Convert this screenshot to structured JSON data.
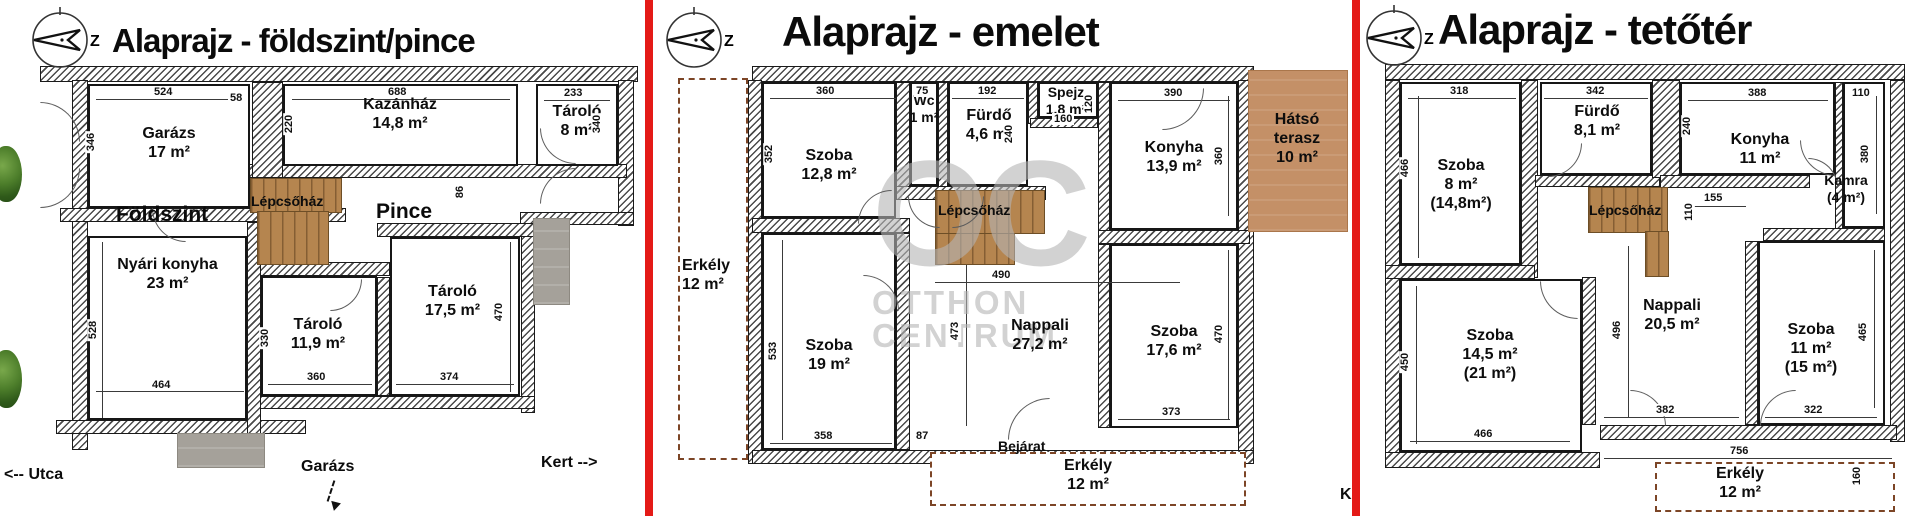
{
  "plans": [
    {
      "title": "Alaprajz - földszint/pince",
      "compass": "Z",
      "stairs": "Lépcsőház",
      "floor_left": "Földszint",
      "floor_right": "Pince",
      "rooms": {
        "garazs": {
          "name": "Garázs",
          "area": "17 m²"
        },
        "kazanhaz": {
          "name": "Kazánház",
          "area": "14,8 m²"
        },
        "tarolo8": {
          "name": "Tároló",
          "area": "8 m²"
        },
        "nyari": {
          "name": "Nyári konyha",
          "area": "23 m²"
        },
        "tarolo119": {
          "name": "Tároló",
          "area": "11,9 m²"
        },
        "tarolo175": {
          "name": "Tároló",
          "area": "17,5 m²"
        }
      },
      "dims": {
        "d524": "524",
        "d58": "58",
        "d688": "688",
        "d233": "233",
        "d346": "346",
        "d220": "220",
        "d340": "340",
        "d86": "86",
        "d528": "528",
        "d464": "464",
        "d330": "330",
        "d360": "360",
        "d470": "470",
        "d374": "374"
      },
      "notes": {
        "utca": "<-- Utca",
        "garazs_arrow": "Garázs",
        "kert": "Kert -->"
      }
    },
    {
      "title": "Alaprajz - emelet",
      "compass": "Z",
      "stairs": "Lépcsőház",
      "rooms": {
        "szoba128": {
          "name": "Szoba",
          "area": "12,8 m²"
        },
        "wc": {
          "name": "Wc",
          "area": "1 m²"
        },
        "furdo": {
          "name": "Fürdő",
          "area": "4,6 m²"
        },
        "spejz": {
          "name": "Spejz",
          "area": "1,8 m²"
        },
        "konyha": {
          "name": "Konyha",
          "area": "13,9 m²"
        },
        "terasz": {
          "name": "Hátsó",
          "name2": "terasz",
          "area": "10 m²"
        },
        "erkely_left": {
          "name": "Erkély",
          "area": "12 m²"
        },
        "szoba19": {
          "name": "Szoba",
          "area": "19 m²"
        },
        "nappali": {
          "name": "Nappali",
          "area": "27,2 m²"
        },
        "szoba176": {
          "name": "Szoba",
          "area": "17,6 m²"
        },
        "erkely_bot": {
          "name": "Erkély",
          "area": "12 m²"
        }
      },
      "dims": {
        "d360": "360",
        "d75": "75",
        "d192": "192",
        "d160": "160",
        "d120": "120",
        "d390": "390",
        "d352": "352",
        "d240": "240",
        "d360r": "360",
        "d490": "490",
        "d473": "473",
        "d533": "533",
        "d358": "358",
        "d87": "87",
        "d373": "373",
        "d470": "470"
      },
      "labels": {
        "bejarat": "Bejárat",
        "k": "K"
      }
    },
    {
      "title": "Alaprajz - tetőtér",
      "compass": "Z",
      "stairs": "Lépcsőház",
      "rooms": {
        "szoba8": {
          "name": "Szoba",
          "area": "8 m²",
          "area2": "(14,8m²)"
        },
        "furdo": {
          "name": "Fürdő",
          "area": "8,1 m²"
        },
        "konyha": {
          "name": "Konyha",
          "area": "11 m²"
        },
        "kamra": {
          "name": "Kamra",
          "area": "(4 m²)"
        },
        "szoba145": {
          "name": "Szoba",
          "area": "14,5 m²",
          "area2": "(21 m²)"
        },
        "nappali": {
          "name": "Nappali",
          "area": "20,5 m²"
        },
        "szoba11": {
          "name": "Szoba",
          "area": "11 m²",
          "area2": "(15 m²)"
        },
        "erkely": {
          "name": "Erkély",
          "area": "12 m²"
        }
      },
      "dims": {
        "d318": "318",
        "d342": "342",
        "d388": "388",
        "d110": "110",
        "d466": "466",
        "d240": "240",
        "d380": "380",
        "d155": "155",
        "d110b": "110",
        "d450": "450",
        "d496": "496",
        "d465": "465",
        "d466b": "466",
        "d382": "382",
        "d322": "322",
        "d756": "756",
        "d160": "160"
      }
    }
  ],
  "watermark": {
    "monogram": "OC",
    "line1": "OTTHON",
    "line2": "CENTRUM"
  },
  "colors": {
    "divider": "#e41a17",
    "stairs": "#b5854f",
    "terrace": "#c49067",
    "watermark": "#b5b5b5"
  }
}
